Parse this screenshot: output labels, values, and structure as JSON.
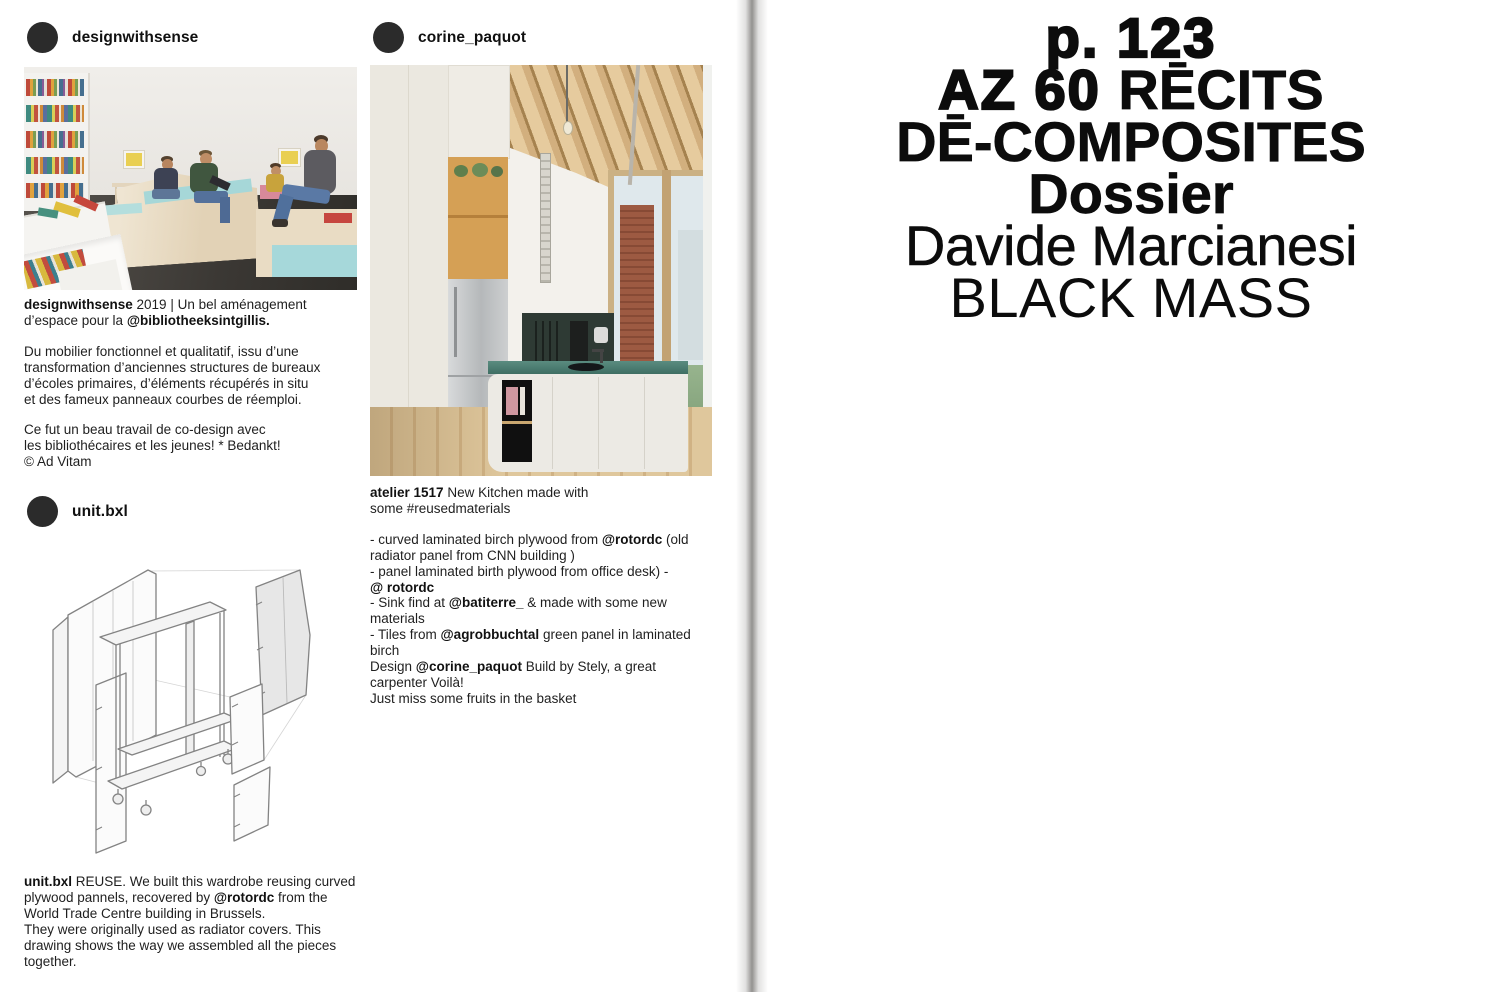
{
  "colors": {
    "avatar": "#2b2b2b",
    "title_text": "#0c0c0c",
    "body_text": "#1f1f1f",
    "spine_gray": "#696764",
    "seat_teal": "#a6d7d8",
    "counter_teal": "#46756b",
    "beam_wood": "#d2af7e"
  },
  "posts": [
    {
      "username": "designwithsense",
      "caption_lead": [
        {
          "t": "designwithsense",
          "b": 1
        },
        {
          "t": " 2019 | Un bel aménagement\nd’espace pour la ",
          "b": 0
        },
        {
          "t": "@bibliotheeksintgillis.",
          "b": 1
        }
      ],
      "caption_body": [
        {
          "t": "Du mobilier fonctionnel et qualitatif, issu d’une\ntransformation d’anciennes structures de bureaux\nd’écoles primaires, d’éléments récupérés in situ\net des fameux panneaux courbes de réemploi.",
          "b": 0
        }
      ],
      "caption_footer": [
        {
          "t": "Ce fut un beau travail de co-design avec\nles bibliothécaires et les jeunes! * Bedankt!\n© Ad Vitam",
          "b": 0
        }
      ]
    },
    {
      "username": "corine_paquot",
      "caption_lead": [
        {
          "t": "atelier 1517",
          "b": 1
        },
        {
          "t": "  New Kitchen made with\nsome #reusedmaterials",
          "b": 0
        }
      ],
      "caption_body": [
        {
          "t": "- curved laminated birch plywood from ",
          "b": 0
        },
        {
          "t": "@rotordc",
          "b": 1
        },
        {
          "t": " (old\nradiator panel from CNN building )\n- panel laminated birth plywood from office desk) -\n",
          "b": 0
        },
        {
          "t": "@ rotordc",
          "b": 1
        },
        {
          "t": "\n- Sink find at ",
          "b": 0
        },
        {
          "t": "@batiterre_",
          "b": 1
        },
        {
          "t": " & made with some new\nmaterials\n- Tiles from ",
          "b": 0
        },
        {
          "t": "@agrobbuchtal",
          "b": 1
        },
        {
          "t": " green panel in laminated\nbirch\nDesign ",
          "b": 0
        },
        {
          "t": "@corine_paquot",
          "b": 1
        },
        {
          "t": " Build by Stely, a great\ncarpenter Voilà!\nJust miss some fruits in the basket",
          "b": 0
        }
      ]
    },
    {
      "username": "unit.bxl",
      "caption_lead": [
        {
          "t": "unit.bxl",
          "b": 1
        },
        {
          "t": "  REUSE. We built this wardrobe reusing curved\nplywood pannels, recovered by ",
          "b": 0
        },
        {
          "t": "@rotordc",
          "b": 1
        },
        {
          "t": " from the\nWorld Trade Centre building in Brussels.\nThey were originally used as radiator covers. This\ndrawing shows the way we assembled all the pieces\ntogether.",
          "b": 0
        }
      ]
    }
  ],
  "title": {
    "lines": [
      {
        "segments": [
          {
            "t": "p. 123",
            "w": "black"
          }
        ]
      },
      {
        "segments": [
          {
            "t": "AZ 60 ",
            "w": "black"
          },
          {
            "t": "RĒCITS",
            "w": "bold"
          }
        ]
      },
      {
        "segments": [
          {
            "t": "DĒ-COMPOSITES",
            "w": "bold"
          }
        ]
      },
      {
        "segments": [
          {
            "t": "Dossier",
            "w": "bold"
          }
        ]
      },
      {
        "segments": [
          {
            "t": "Davide Marcianesi",
            "w": "medium"
          }
        ]
      },
      {
        "segments": [
          {
            "t": "BLACK MASS",
            "w": "light"
          }
        ]
      }
    ]
  }
}
